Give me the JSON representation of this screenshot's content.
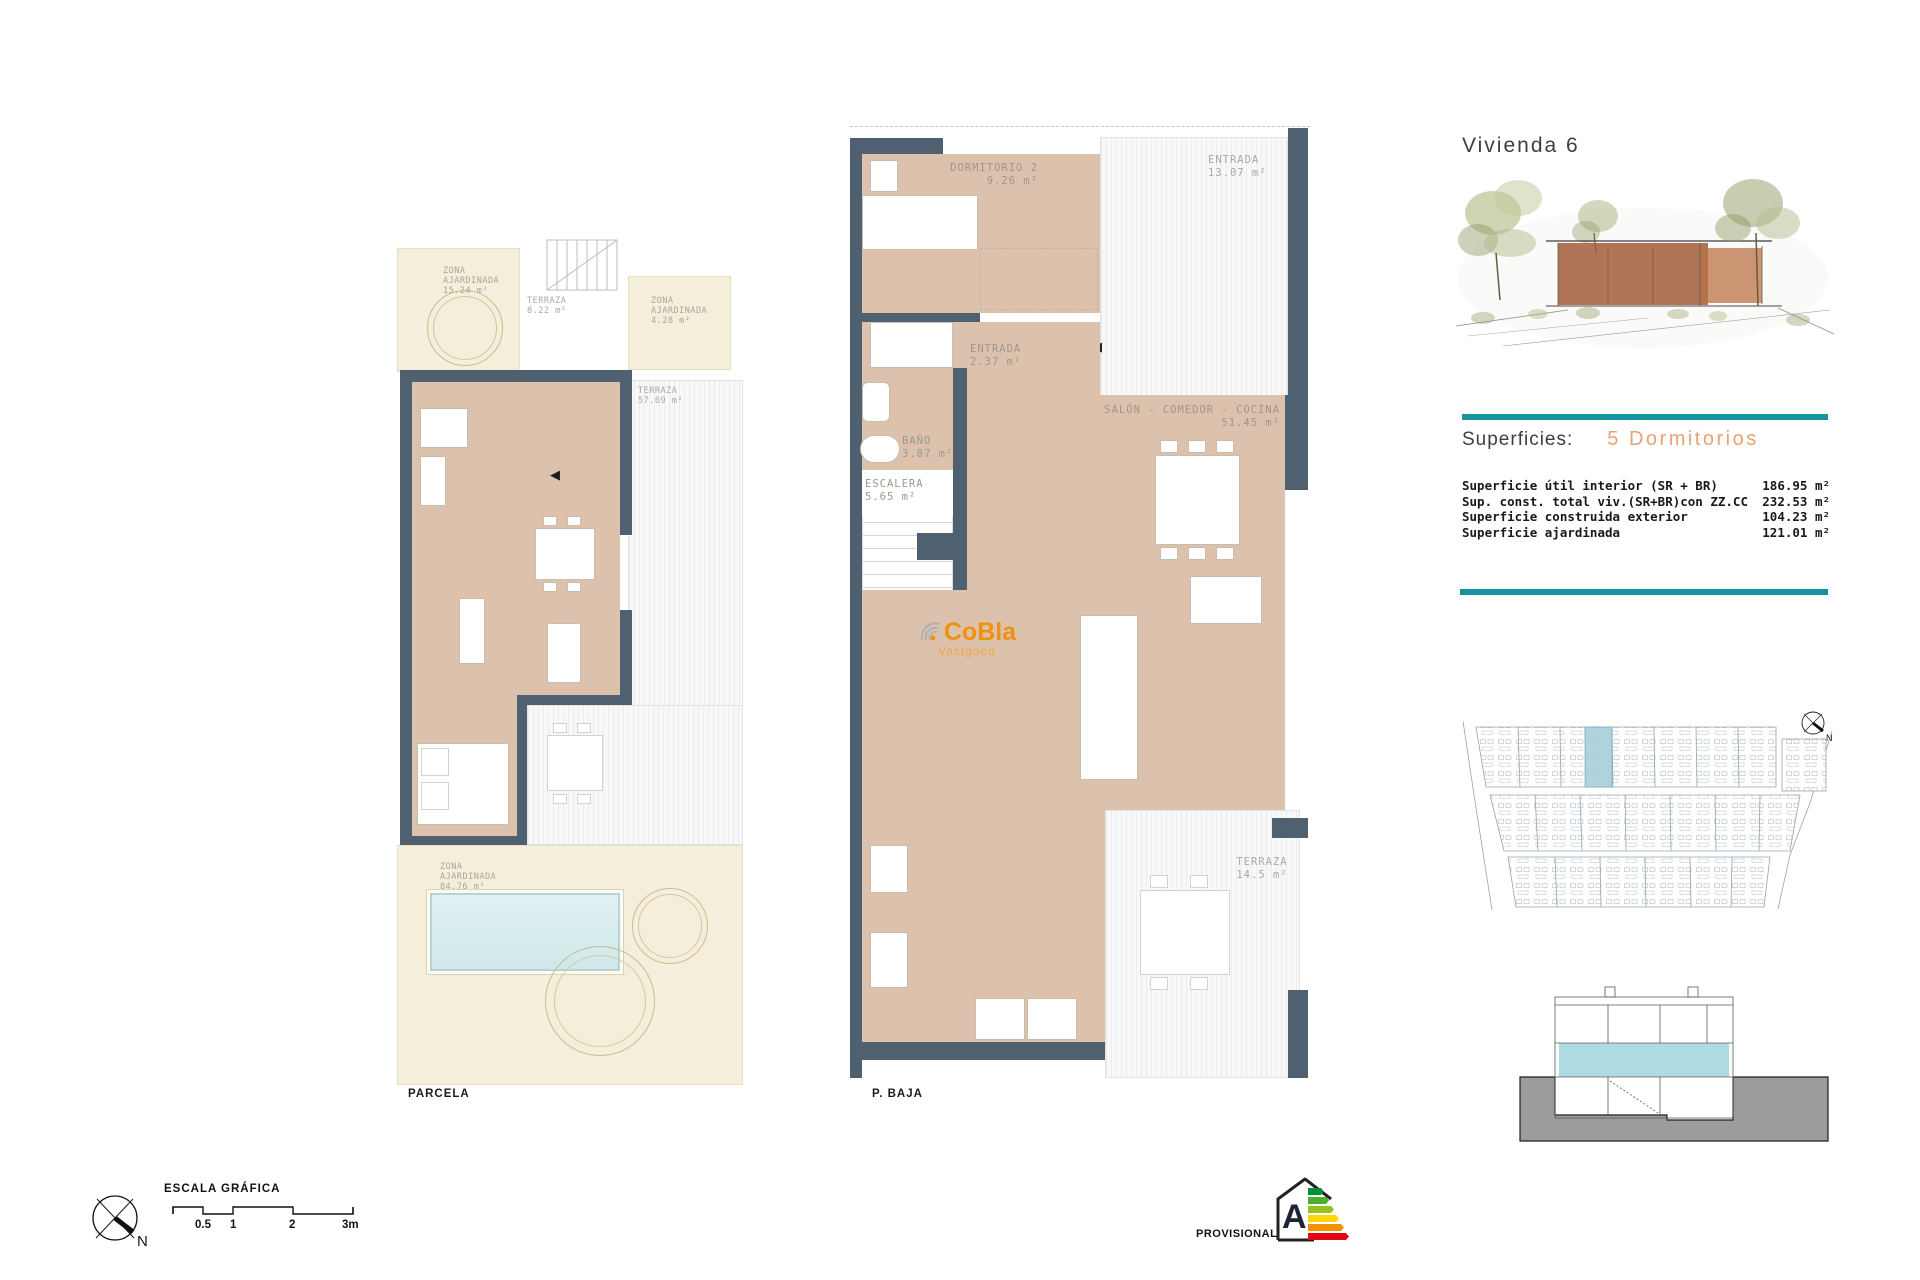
{
  "header": {
    "title": "Vivienda 6"
  },
  "superficies": {
    "heading": "Superficies:",
    "bedrooms": "5 Dormitorios",
    "rows": [
      {
        "label": "Superficie útil interior (SR + BR)",
        "value": "186.95 m²"
      },
      {
        "label": "Sup. const. total viv.(SR+BR)con ZZ.CC",
        "value": "232.53 m²"
      },
      {
        "label": "Superficie construida exterior",
        "value": "104.23 m²"
      },
      {
        "label": "Superficie ajardinada",
        "value": "121.01 m²"
      }
    ]
  },
  "plans": {
    "parcela": {
      "caption": "PARCELA",
      "labels": [
        {
          "lines": [
            "ZONA",
            "AJARDINADA",
            "15.24 m²"
          ]
        },
        {
          "lines": [
            "TERRAZA",
            "8.22 m²"
          ]
        },
        {
          "lines": [
            "ZONA",
            "AJARDINADA",
            "4.28 m²"
          ]
        },
        {
          "lines": [
            "TERRAZA",
            "57.69 m²"
          ]
        },
        {
          "lines": [
            "ZONA",
            "AJARDINADA",
            "84.76 m²"
          ]
        }
      ]
    },
    "baja": {
      "caption": "P. BAJA",
      "labels": [
        {
          "lines": [
            "DORMITORIO 2",
            "9.26 m²"
          ]
        },
        {
          "lines": [
            "ENTRADA",
            "13.07 m²"
          ]
        },
        {
          "lines": [
            "ENTRADA",
            "2.37 m²"
          ]
        },
        {
          "lines": [
            "BAÑO",
            "3.87 m²"
          ]
        },
        {
          "lines": [
            "ESCALERA",
            "5.65 m²"
          ]
        },
        {
          "lines": [
            "SALÓN - COMEDOR - COCINA",
            "51.45 m²"
          ]
        },
        {
          "lines": [
            "TERRAZA",
            "14.5 m²"
          ]
        }
      ]
    }
  },
  "watermark": {
    "brand": "CoBla",
    "sub": "Vastgoed"
  },
  "scale": {
    "title": "ESCALA GRÁFICA",
    "ticks": [
      "0.5",
      "1",
      "2",
      "3m"
    ]
  },
  "compass": {
    "north": "N"
  },
  "stamp": {
    "text": "PROVISIONAL"
  },
  "energy": {
    "rating": "A"
  },
  "colors": {
    "accent_teal": "#17939e",
    "highlight_orange": "#e9a273",
    "brand_orange": "#ef9110",
    "wall": "#4f6170",
    "floor_tan": "#dcc2ac",
    "garden_cream": "#f5eedb",
    "pool_blue": "#d9edee",
    "site_unit_highlight": "#a9cfdb",
    "section_band": "#aedae2",
    "energy_bar_colors": [
      "#008f39",
      "#4caf2e",
      "#97c11f",
      "#ffd500",
      "#f39200",
      "#e30613"
    ]
  }
}
